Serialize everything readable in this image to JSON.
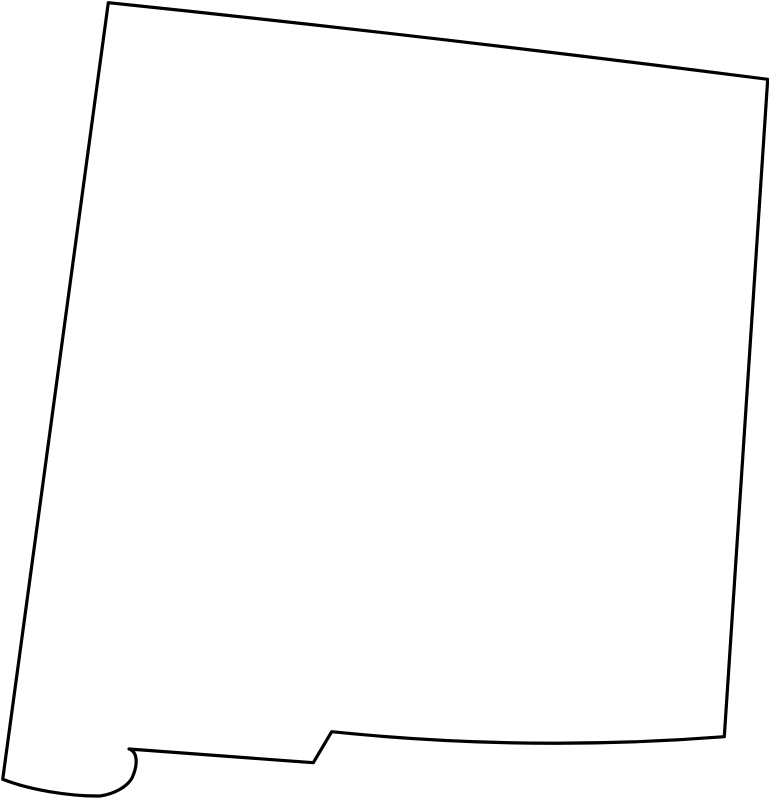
{
  "map": {
    "region_name": "New Mexico",
    "map_type": "state-outline",
    "background_color": "#ffffff",
    "fill_color": "#ffffff",
    "stroke_color": "#000000",
    "stroke_width": "3.2",
    "viewbox": "0 0 769 800",
    "outline_path": "M 108.3,2.7 Q 438,37 767.7,79.3 L 724.3,736.7 Q 528,752 331.7,731.7 L 313.3,762.7 L 129,749 C 138,752 138,765 132,778 C 127,787 114,794 100,796 C 70,796.5 30,790 2.7,779.3 Z"
  }
}
